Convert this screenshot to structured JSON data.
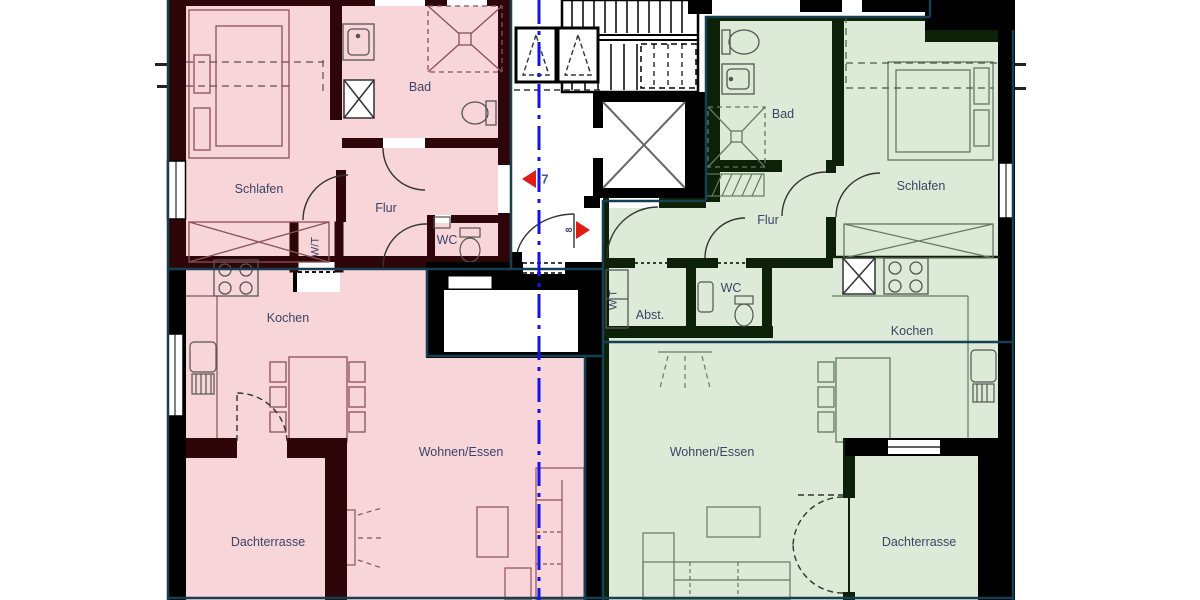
{
  "plan": {
    "type": "floor-plan",
    "axis_line": "section axis (blue dash-dot)",
    "colors": {
      "apartment_left_fill": "#f7d5d8",
      "apartment_left_wall": "#2e060a",
      "apartment_right_fill": "#dcead7",
      "apartment_right_wall": "#0d2008",
      "boundary_outline": "#173f52",
      "axis_blue": "#1512ee",
      "marker_red": "#e01d15",
      "label_text": "#3c4467"
    },
    "apartments": {
      "left": {
        "unit_marker": "7",
        "rooms": {
          "schlafen": "Schlafen",
          "bad": "Bad",
          "flur": "Flur",
          "wc": "WC",
          "wt": "W/T",
          "kochen": "Kochen",
          "wohnen_essen": "Wohnen/Essen",
          "dachterrasse": "Dachterrasse"
        }
      },
      "right": {
        "unit_marker": "8",
        "rooms": {
          "bad": "Bad",
          "schlafen": "Schlafen",
          "flur": "Flur",
          "wc": "WC",
          "abstellraum": "Abst.",
          "wt": "W T",
          "kochen": "Kochen",
          "wohnen_essen": "Wohnen/Essen",
          "dachterrasse": "Dachterrasse"
        }
      }
    }
  }
}
